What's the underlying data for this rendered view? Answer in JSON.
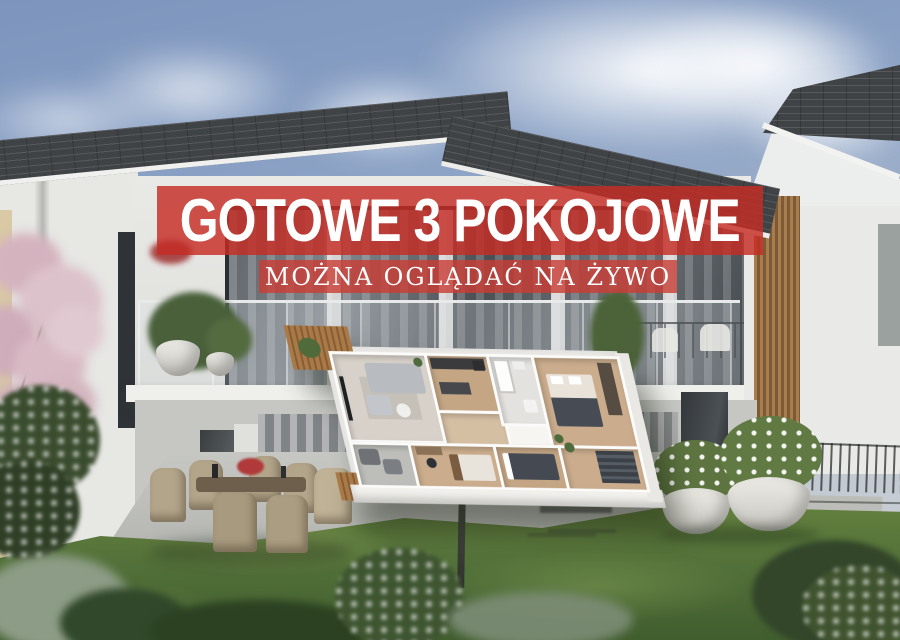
{
  "banner": {
    "headline": "GOTOWE 3 POKOJOWE",
    "subheadline": "MOŻNA OGLĄDAĆ NA ŻYWO"
  },
  "colors": {
    "banner_red": "#c62c24",
    "banner_red_soft": "#cb3c34",
    "text_white": "#ffffff",
    "sky_blue": "#7d95bd",
    "roof_gray": "#44474a",
    "facade_white": "#e5e5e2",
    "wood_accent": "#96703f",
    "lawn_green": "#527039",
    "plan_wood_floor": "#cbad8d"
  }
}
